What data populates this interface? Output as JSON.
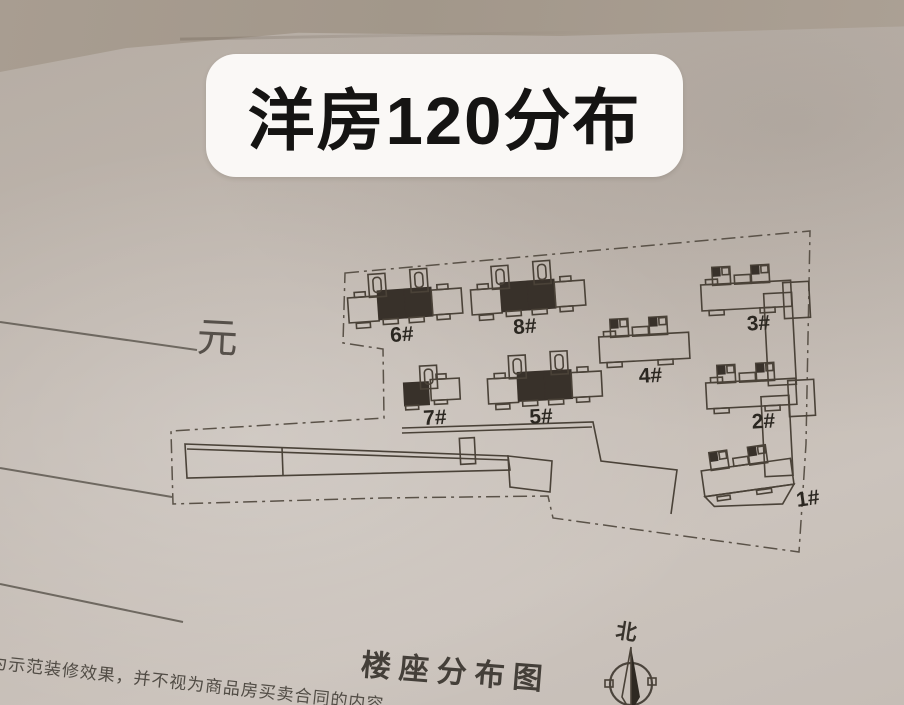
{
  "title": {
    "text": "洋房120分布"
  },
  "price_note": {
    "yuan_label": "元"
  },
  "site_plan": {
    "caption": "楼座分布图",
    "compass_label": "北",
    "highlight_color": "#38312a",
    "line_color": "#4a4238",
    "buildings": [
      {
        "label": "6#",
        "type": "slabDark",
        "highlighted": true,
        "x": 347,
        "y": 291,
        "rot": -4
      },
      {
        "label": "8#",
        "type": "slabDark",
        "highlighted": true,
        "x": 470,
        "y": 283,
        "rot": -4
      },
      {
        "label": "3#",
        "type": "slabExt",
        "highlighted": false,
        "x": 700,
        "y": 272,
        "rot": -3
      },
      {
        "label": "4#",
        "type": "slabCore",
        "highlighted": false,
        "x": 598,
        "y": 324,
        "rot": -3
      },
      {
        "label": "7#",
        "type": "smallDark",
        "highlighted": true,
        "x": 403,
        "y": 376,
        "rot": -3
      },
      {
        "label": "5#",
        "type": "slabDark",
        "highlighted": true,
        "x": 487,
        "y": 372,
        "rot": -3
      },
      {
        "label": "2#",
        "type": "slabExt",
        "highlighted": false,
        "x": 705,
        "y": 370,
        "rot": -3
      },
      {
        "label": "1#",
        "type": "slabAngled",
        "highlighted": false,
        "x": 700,
        "y": 462,
        "rot": -8
      }
    ]
  },
  "disclaimer": {
    "text": "为示范装修效果，并不视为商品房买卖合同的内容"
  },
  "photo": {
    "paper_color": "#c3bab2",
    "top_band_color": "#a59a8e"
  }
}
